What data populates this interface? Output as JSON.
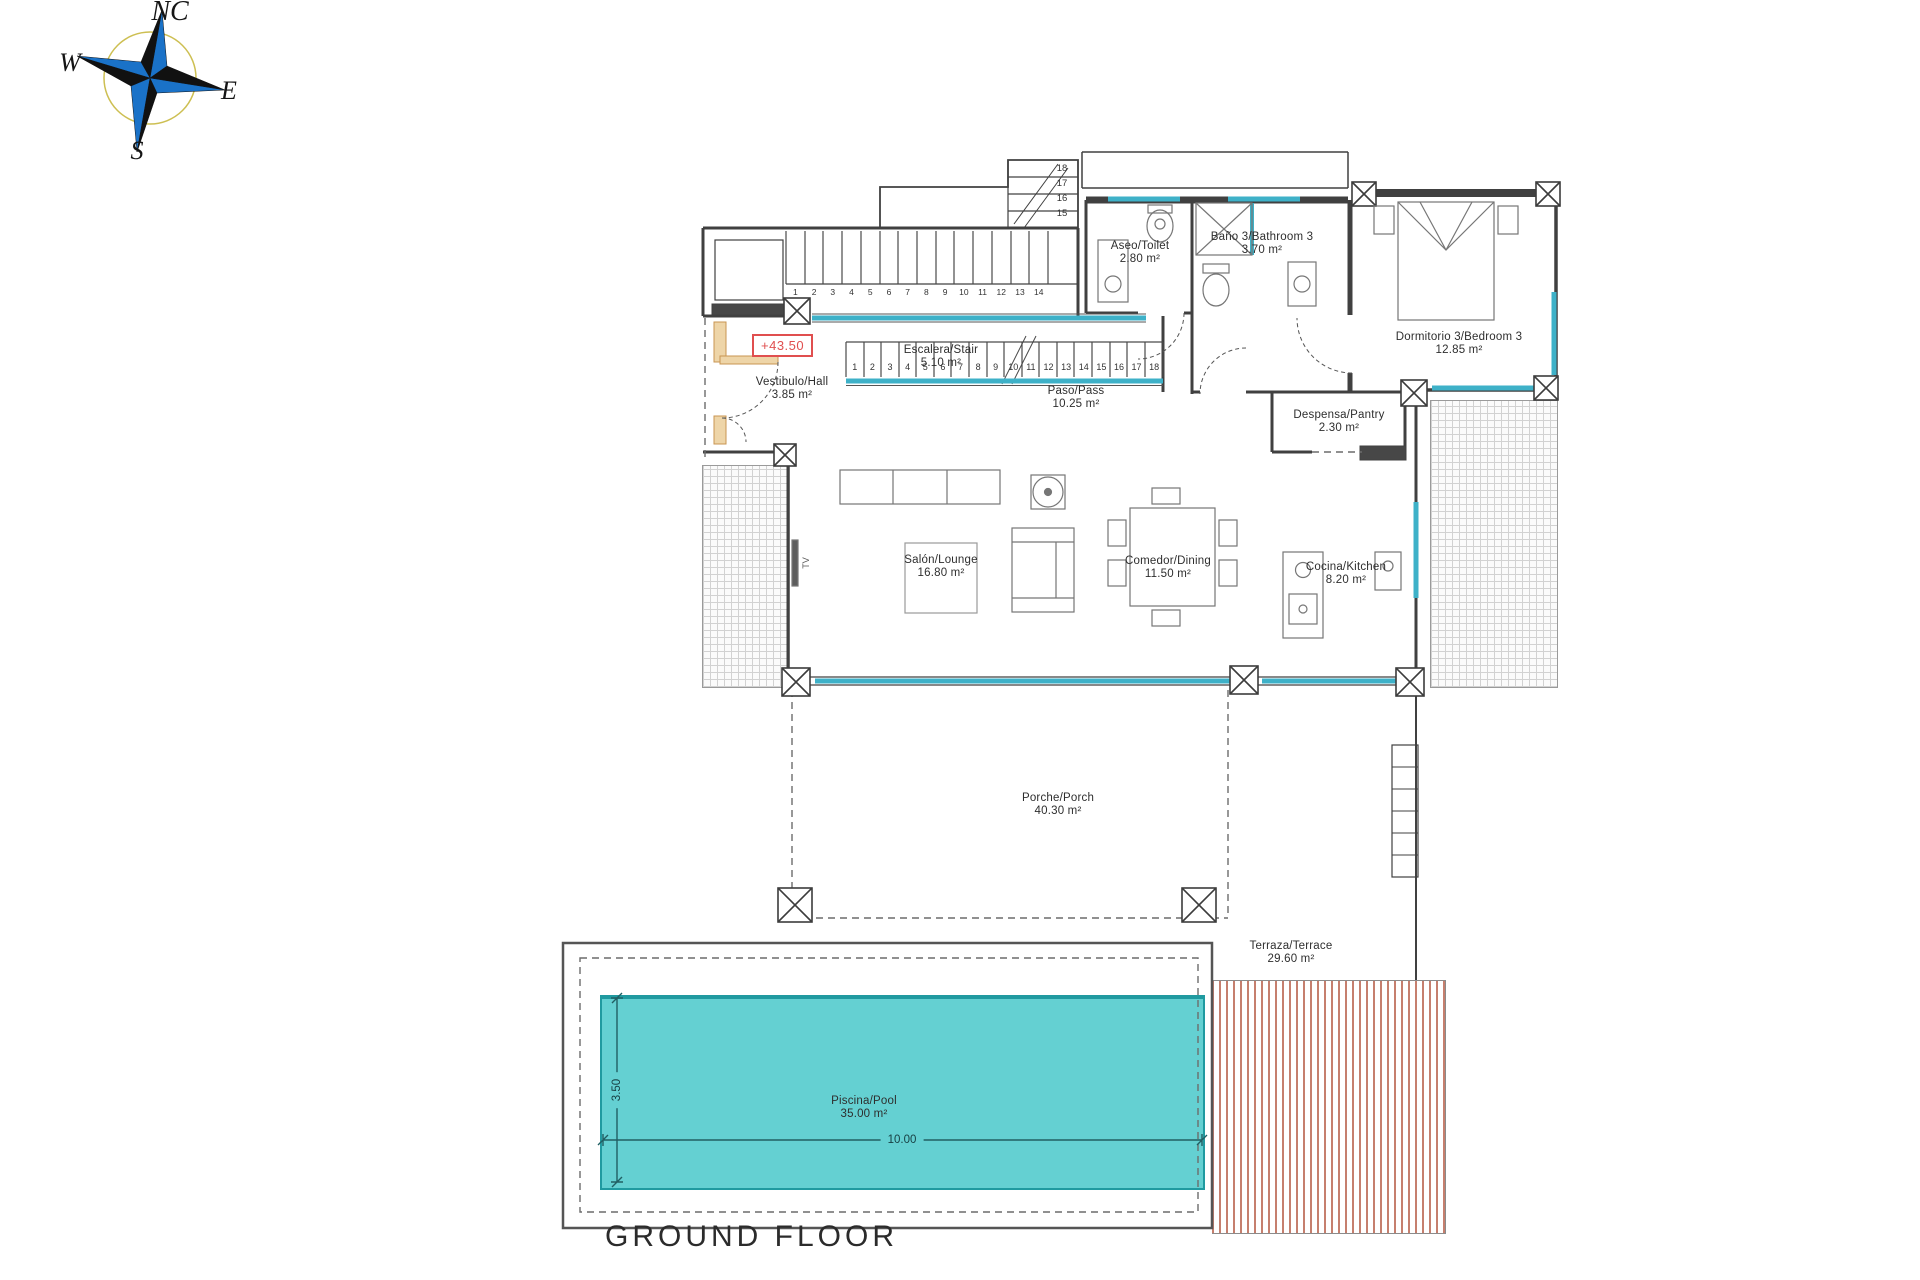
{
  "title": "GROUND FLOOR",
  "elevation_marker": "+43.50",
  "compass": {
    "north": "NC",
    "east": "E",
    "south": "S",
    "west": "W"
  },
  "tv_label": "TV",
  "rooms": [
    {
      "name": "Vestibulo/Hall",
      "area": "3.85 m²"
    },
    {
      "name": "Escalera/Stair",
      "area": "5.10 m²"
    },
    {
      "name": "Paso/Pass",
      "area": "10.25 m²"
    },
    {
      "name": "Aseo/Toilet",
      "area": "2.80 m²"
    },
    {
      "name": "Baño 3/Bathroom 3",
      "area": "3.70 m²"
    },
    {
      "name": "Dormitorio 3/Bedroom 3",
      "area": "12.85 m²"
    },
    {
      "name": "Despensa/Pantry",
      "area": "2.30 m²"
    },
    {
      "name": "Salón/Lounge",
      "area": "16.80 m²"
    },
    {
      "name": "Comedor/Dining",
      "area": "11.50 m²"
    },
    {
      "name": "Cocina/Kitchen",
      "area": "8.20 m²"
    },
    {
      "name": "Porche/Porch",
      "area": "40.30 m²"
    },
    {
      "name": "Terraza/Terrace",
      "area": "29.60 m²"
    },
    {
      "name": "Piscina/Pool",
      "area": "35.00 m²"
    }
  ],
  "pool_dimensions": {
    "length": "10.00",
    "width": "3.50"
  },
  "stairs": {
    "upper_run": [
      "1",
      "2",
      "3",
      "4",
      "5",
      "6",
      "7",
      "8",
      "9",
      "10",
      "11",
      "12",
      "13",
      "14"
    ],
    "turn_run": [
      "18",
      "17",
      "16",
      "15"
    ],
    "lower_run": [
      "1",
      "2",
      "3",
      "4",
      "5",
      "6",
      "7",
      "8",
      "9",
      "10",
      "11",
      "12",
      "13",
      "14",
      "15",
      "16",
      "17",
      "18"
    ]
  },
  "colors": {
    "wall": "#404040",
    "window": "#3eb1c8",
    "pool_fill": "#64d0d2",
    "pool_edge": "#209aa0",
    "deck_stripe": "#c67f6e",
    "marker_red": "#e04f4f",
    "door_wood": "#eed5a8"
  }
}
